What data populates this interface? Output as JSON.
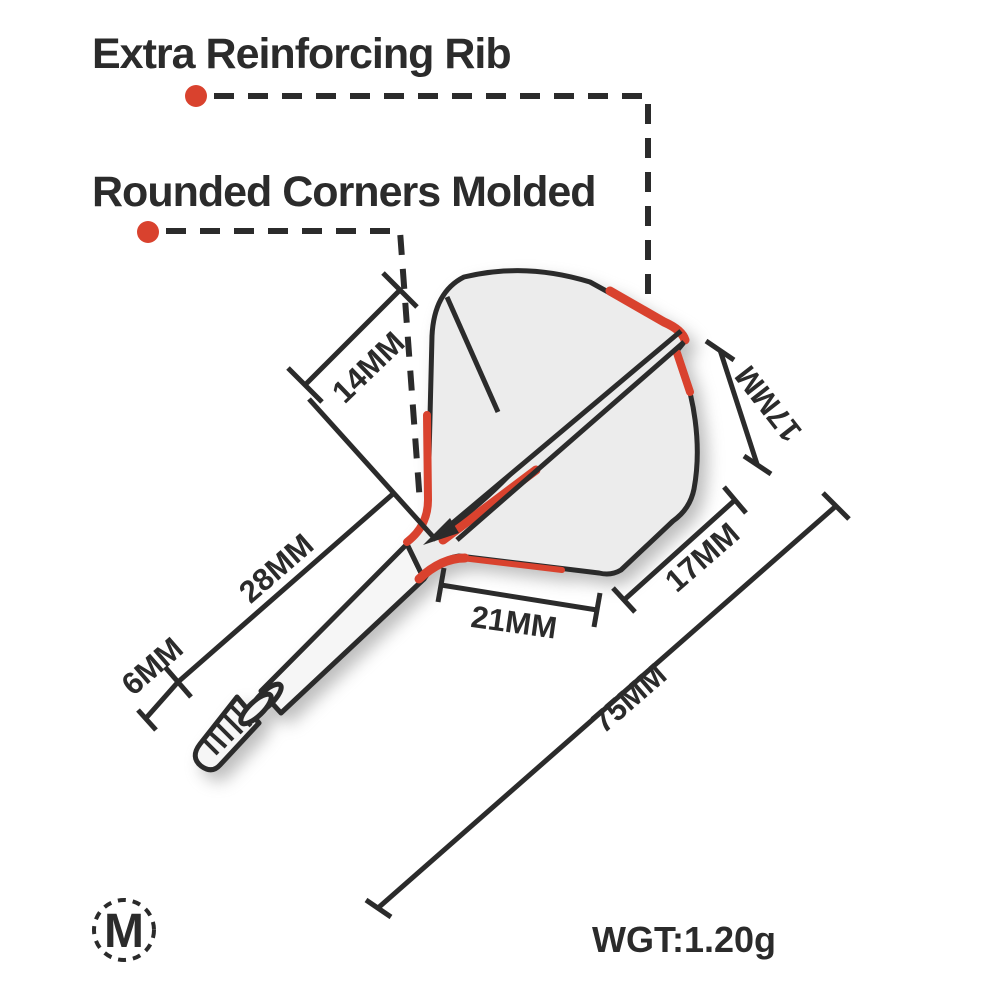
{
  "annotations": {
    "extra_rib": "Extra Reinforcing Rib",
    "rounded_corners": "Rounded Corners Molded"
  },
  "dimensions": {
    "rib_length": "14MM",
    "shaft_length": "28MM",
    "thread_length": "6MM",
    "flight_bottom_width": "21MM",
    "flight_rear_edge": "17MM",
    "flight_side_edge": "17MM",
    "total_length": "75MM"
  },
  "weight_label": "WGT:1.20g",
  "logo_letter": "M",
  "colors": {
    "ink": "#2b2b2b",
    "accent_red": "#d9422e",
    "flight_fill": "#ececec",
    "shaft_fill": "#f6f6f6"
  }
}
